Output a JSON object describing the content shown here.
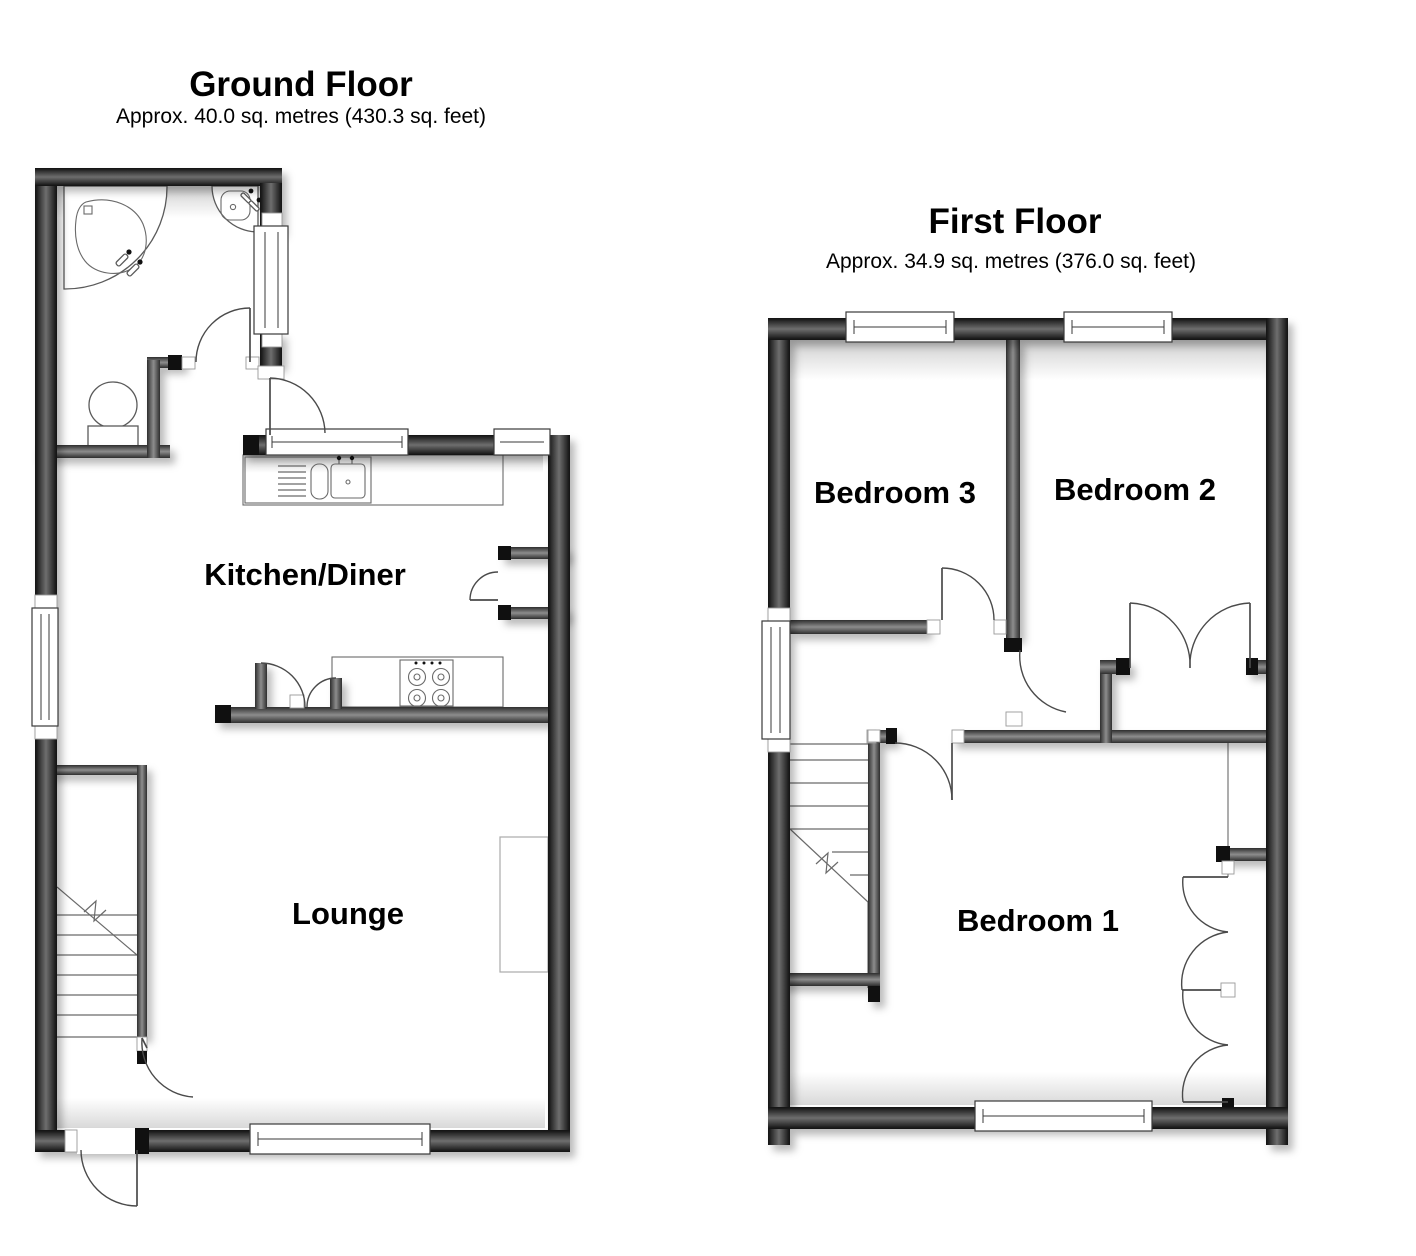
{
  "ground_floor": {
    "title": "Ground Floor",
    "subtitle": "Approx. 40.0 sq. metres (430.3 sq. feet)",
    "rooms": [
      {
        "label": "Kitchen/Diner"
      },
      {
        "label": "Lounge"
      }
    ],
    "fixtures": [
      "corner-bath",
      "corner-basin",
      "toilet",
      "sink-unit",
      "hob",
      "staircase",
      "fireplace",
      "front-door"
    ]
  },
  "first_floor": {
    "title": "First Floor",
    "subtitle": "Approx. 34.9 sq. metres (376.0 sq. feet)",
    "rooms": [
      {
        "label": "Bedroom 3"
      },
      {
        "label": "Bedroom 2"
      },
      {
        "label": "Bedroom 1"
      }
    ],
    "fixtures": [
      "staircase",
      "built-in-wardrobe"
    ]
  },
  "colors": {
    "background": "#ffffff",
    "exterior_wall_edge": "#101010",
    "exterior_wall_core": "#6e6e6e",
    "interior_wall_edge": "#2e2e2e",
    "interior_wall_core": "#8d8d8d",
    "line": "#555555",
    "text": "#000000"
  }
}
